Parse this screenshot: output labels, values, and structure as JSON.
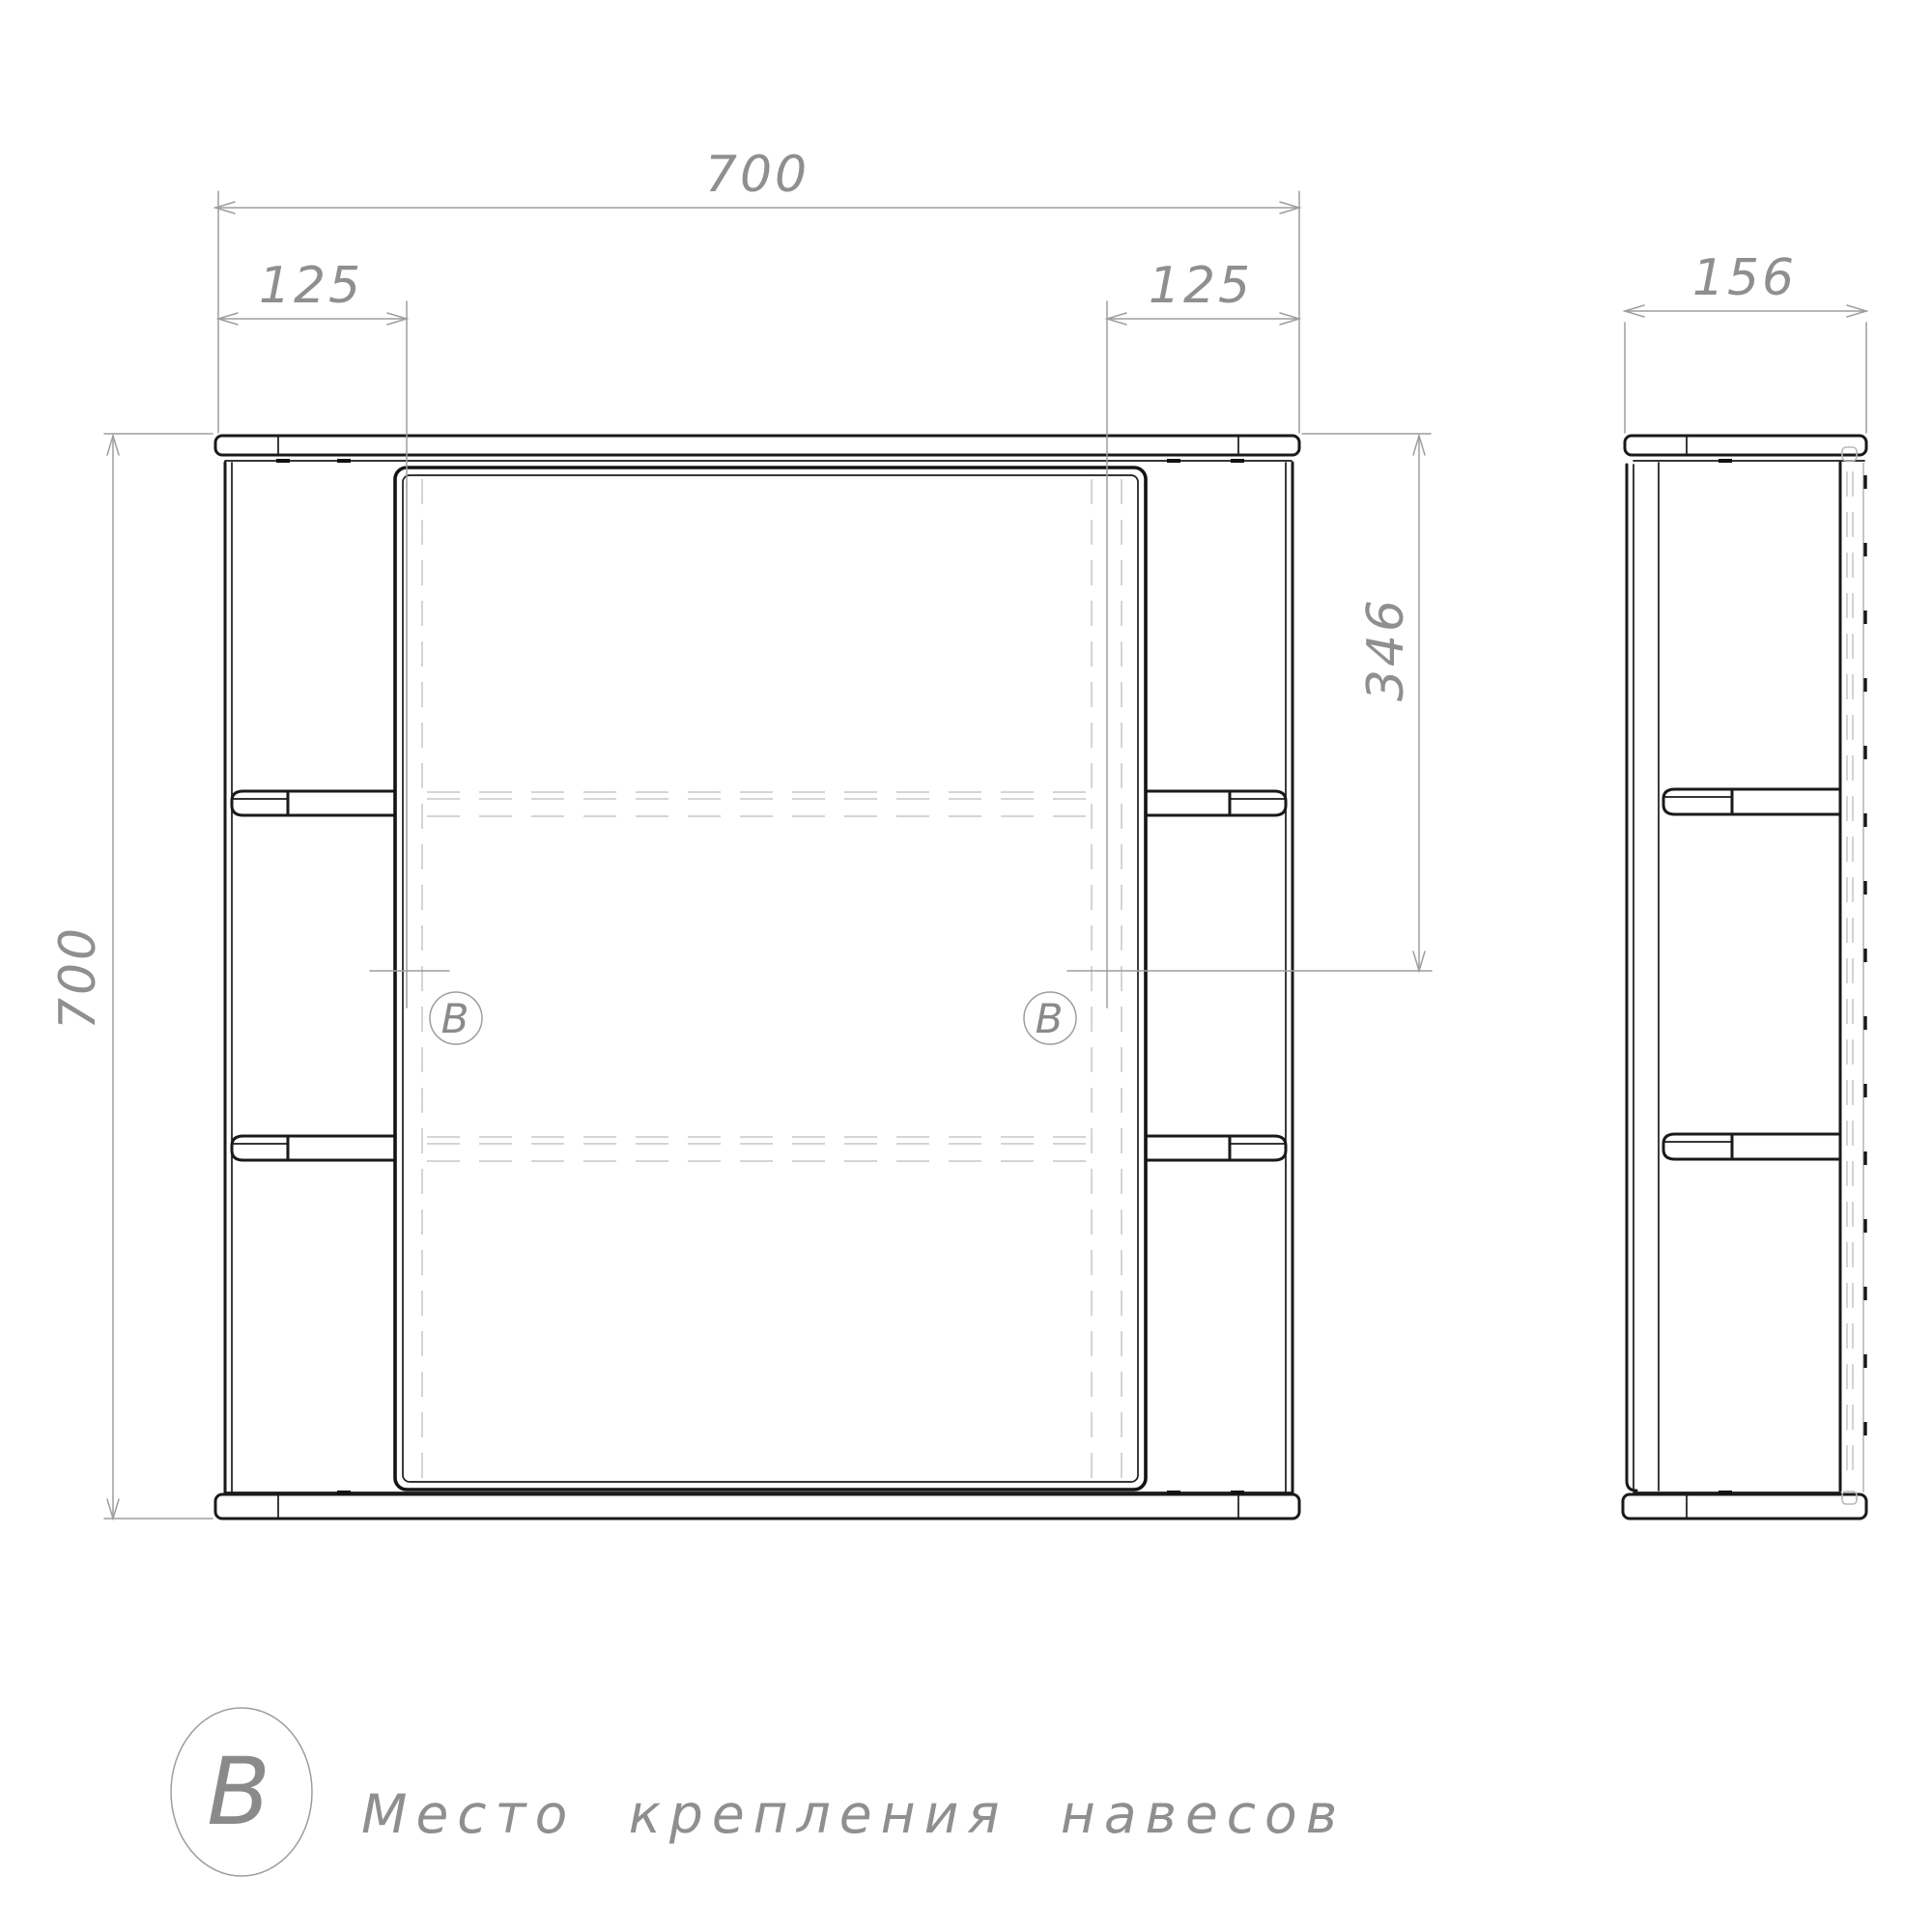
{
  "drawing": {
    "views": {
      "front": {
        "name": "front view",
        "width_dim": "700",
        "height_dim": "700",
        "left_mount_offset_dim": "125",
        "right_mount_offset_dim": "125",
        "mount_height_dim": "346"
      },
      "side": {
        "name": "side view",
        "depth_dim": "156"
      }
    },
    "markers": {
      "left": "B",
      "right": "B"
    },
    "legend": {
      "symbol": "B",
      "label": "Место крепления навесов"
    },
    "colors": {
      "object_line": "#1a1a1a",
      "dimension_line": "#9e9e9e",
      "hidden_line": "#c7c7c7",
      "annotation_text": "#8f8f8f",
      "background": "#ffffff"
    }
  }
}
